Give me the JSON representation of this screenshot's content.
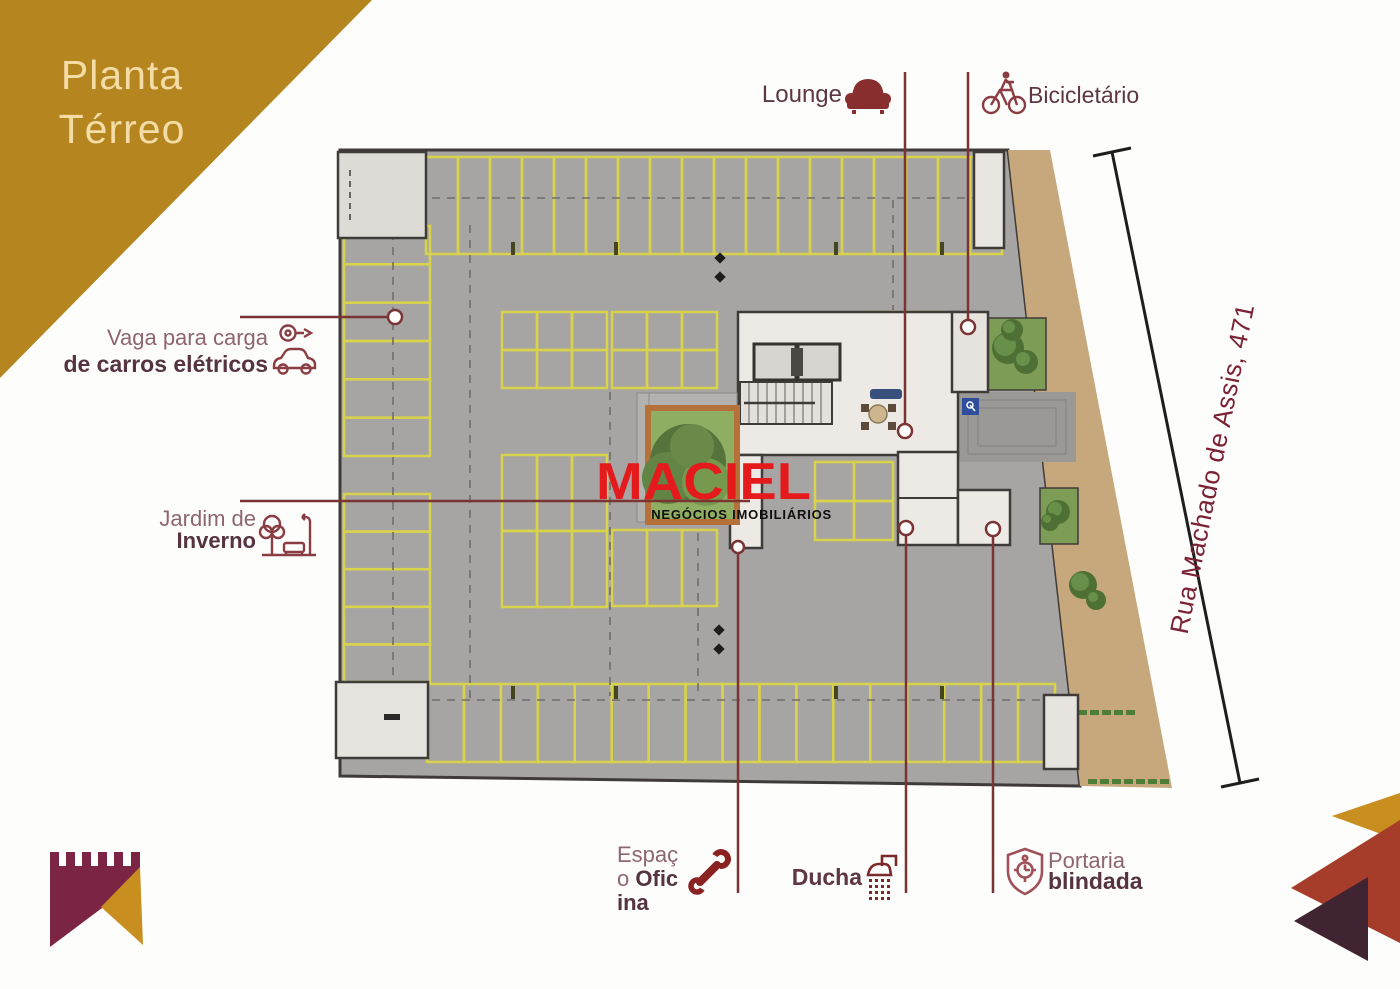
{
  "page": {
    "title_line1": "Planta",
    "title_line2": "Térreo"
  },
  "brand": {
    "logo_text": "MACIEL",
    "logo_subtext": "NEGÓCIOS IMOBILIÁRIOS",
    "logo_color": "#e41a1c"
  },
  "street": {
    "label": "Rua Machado de Assis, 471"
  },
  "annotations": {
    "lounge": {
      "label": "Lounge",
      "icon": "sofa-icon"
    },
    "bike_parking": {
      "label": "Bicicletário",
      "icon": "bicycle-icon"
    },
    "ev_charging": {
      "label_line1": "Vaga para carga",
      "label_line2": "de carros elétricos",
      "icon": "electric-car-icon"
    },
    "winter_garden": {
      "label_line1": "Jardim de",
      "label_line2": "Inverno",
      "icon": "winter-garden-icon"
    },
    "workshop": {
      "label_line1": "Espaço",
      "label_line2": "Oficina",
      "icon": "wrench-icon"
    },
    "shower": {
      "label": "Ducha",
      "icon": "shower-icon"
    },
    "armored_lobby": {
      "label_line1": "Portaria",
      "label_line2": "blindada",
      "icon": "shield-icon"
    }
  },
  "colors": {
    "corner_gold": "#b5851f",
    "banner_maroon": "#7c2444",
    "triangle_brick": "#a63d2b",
    "triangle_plum": "#412432",
    "annotation_red": "#7a3434",
    "label_dark": "#553340",
    "label_light": "#8f666d",
    "logo_red": "#e41a1c",
    "stall_yellow": "#d9d24b",
    "garage_gray": "#a6a5a3",
    "sidewalk_tan": "#c7a87c",
    "title_cream": "#f3dca6"
  }
}
